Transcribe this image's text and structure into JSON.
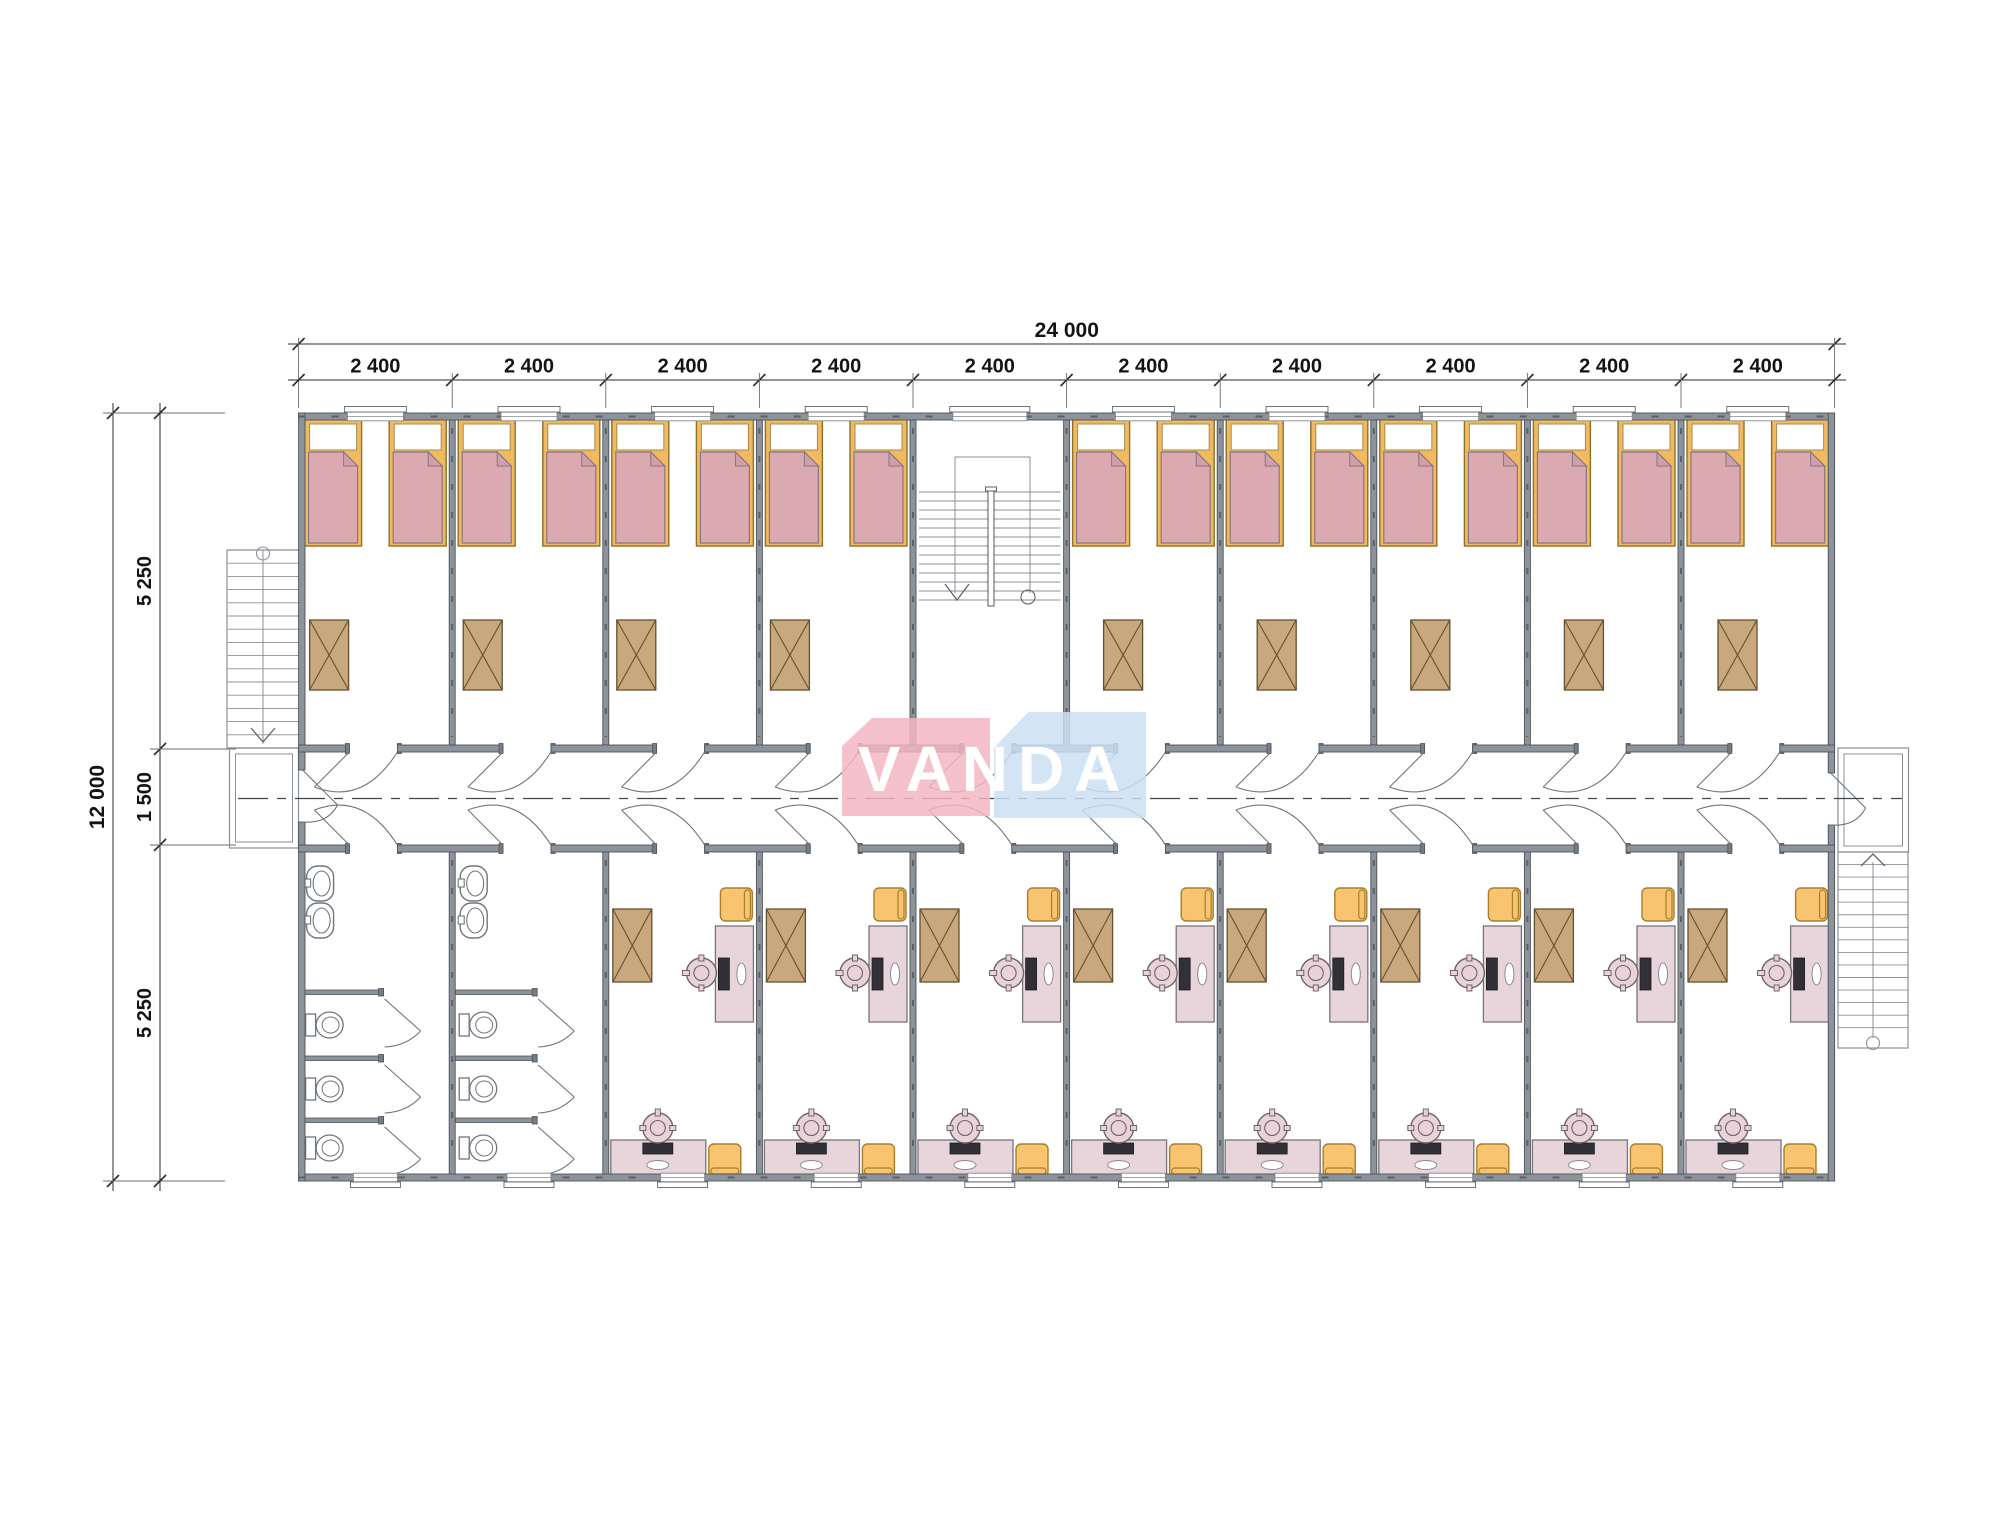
{
  "logo": {
    "text": "VANDA",
    "pink_block_color": "#f3b6c1",
    "blue_block_color": "#cbdff2",
    "text_color": "#ffffff"
  },
  "dimensions": {
    "total_width_label": "24 000",
    "bay_labels": [
      "2 400",
      "2 400",
      "2 400",
      "2 400",
      "2 400",
      "2 400",
      "2 400",
      "2 400",
      "2 400",
      "2 400"
    ],
    "total_height_label": "12 000",
    "height_segment_labels": [
      "5 250",
      "1 500",
      "5 250"
    ]
  },
  "layout": {
    "bay_count": 10,
    "stair_bay_index": 4,
    "bathroom_bays": [
      0,
      1
    ],
    "bedroom_count": 9,
    "beds_per_bedroom": 2,
    "office_count": 8
  },
  "colors": {
    "wall": "#8d939a",
    "wall_edge": "#4d5359",
    "wall_cap": "#767c83",
    "wall_hatch": "#5b6167",
    "stair_line": "#8a9096",
    "door_line": "#6f757c",
    "drawing_line": "#5f656b",
    "bed_frame": "#f0ba60",
    "bed_frame_edge": "#8f6f2c",
    "pillow": "#ffffff",
    "blanket": "#dbaab1",
    "blanket_fold": "#cfa0ab",
    "blanket_edge": "#8a7480",
    "table": "#c8a87c",
    "table_edge": "#64512f",
    "desk": "#e8d5db",
    "desk_edge": "#7b737a",
    "monitor": "#303036",
    "chair_orange": "#f9c470",
    "chair_orange_edge": "#a87e2d",
    "office_chair": "#e9d2d8",
    "office_chair_edge": "#6e656b",
    "fixture": "#ffffff",
    "fixture_edge": "#70767d",
    "centerline": "#41464b",
    "dim_line": "#2b2b2b",
    "ext_line": "#666c72",
    "dim_text": "#141414"
  }
}
